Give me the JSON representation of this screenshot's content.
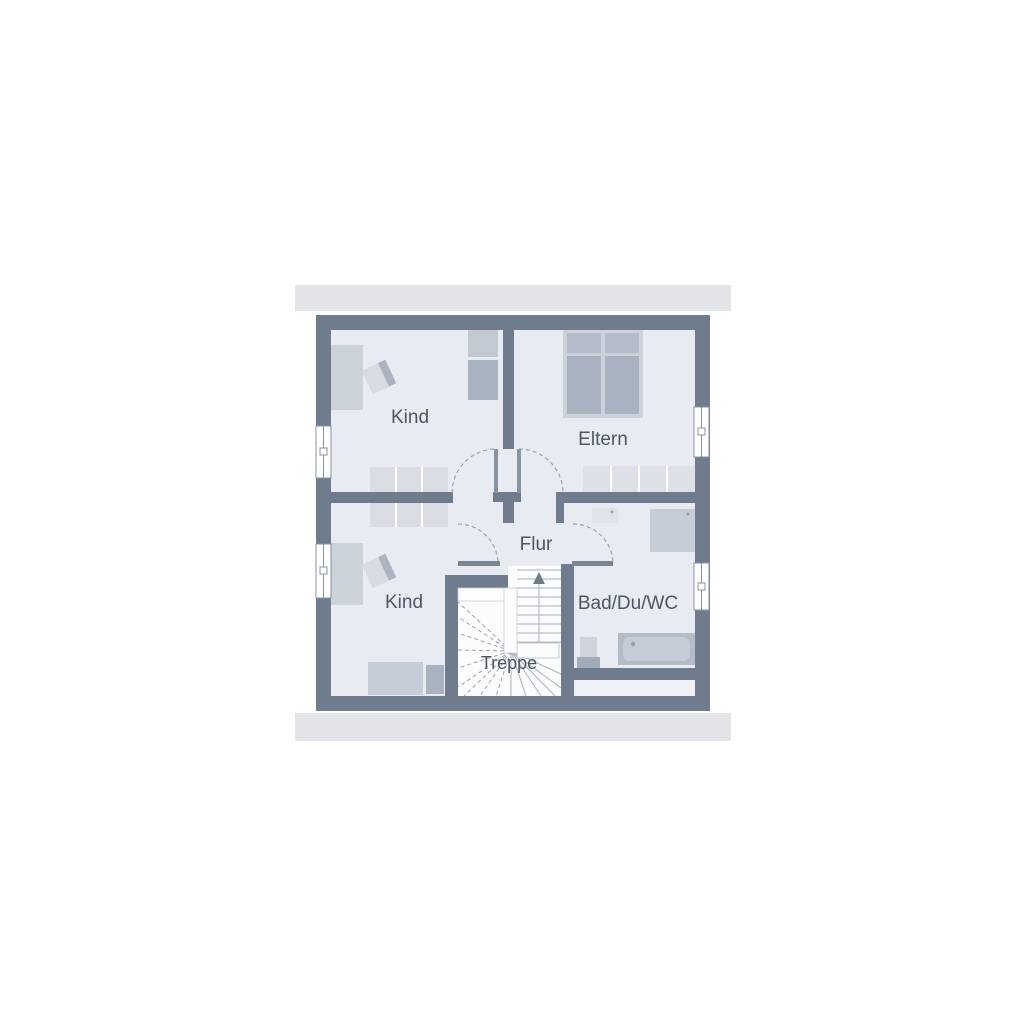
{
  "plan": {
    "type": "floor-plan",
    "floor": "upper-floor",
    "rooms": [
      {
        "id": "kind-top",
        "label": "Kind"
      },
      {
        "id": "eltern",
        "label": "Eltern"
      },
      {
        "id": "flur",
        "label": "Flur"
      },
      {
        "id": "kind-bottom",
        "label": "Kind"
      },
      {
        "id": "bad",
        "label": "Bad/Du/WC"
      },
      {
        "id": "treppe",
        "label": "Treppe"
      }
    ],
    "colors": {
      "wall": "#6f7c8d",
      "room_fill": "#e8ebf1",
      "roof_band": "#e2e4e8",
      "stair_fill": "#fbfcfe",
      "furniture_light": "#d9dde3",
      "furniture_medium": "#ccd2da",
      "furniture_dark": "#a8b2c1",
      "label_text": "#4c5665"
    }
  }
}
